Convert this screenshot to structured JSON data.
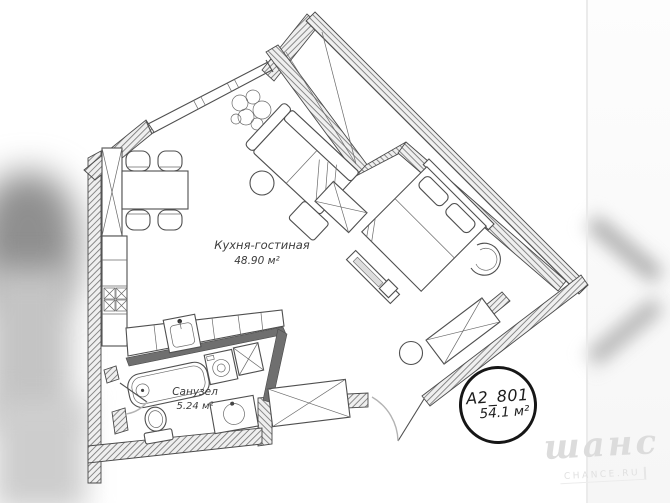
{
  "image": {
    "type": "apartment-floor-plan"
  },
  "rooms": [
    {
      "name": "Кухня-гостиная",
      "area": "48.90 м²"
    },
    {
      "name": "Санузел",
      "area": "5.24 м²"
    }
  ],
  "badge": {
    "unit": "A2_801",
    "area": "54.1 м²"
  },
  "watermark": {
    "logo": "шанс",
    "sub": "CHANCE.RU"
  },
  "colors": {
    "background": "#ffffff",
    "line": "#4f4f4f",
    "wall_hatch": "#777777",
    "wall_fill": "#efefef",
    "badge_border": "#161616",
    "label_text": "#3c3c3c",
    "watermark": "#dcdcdc"
  },
  "furniture_icons": [
    "window",
    "loggia-storage",
    "dining-table",
    "chair",
    "tall-cabinet",
    "kitchen-counter",
    "cooktop",
    "kitchen-sink",
    "sofa",
    "side-table",
    "plant",
    "wardrobe",
    "bed",
    "tv-console",
    "armchair",
    "stool",
    "bathtub",
    "washing-machine",
    "bathroom-cabinet",
    "toilet",
    "vanity-sink",
    "entrance-door",
    "bathroom-door"
  ]
}
